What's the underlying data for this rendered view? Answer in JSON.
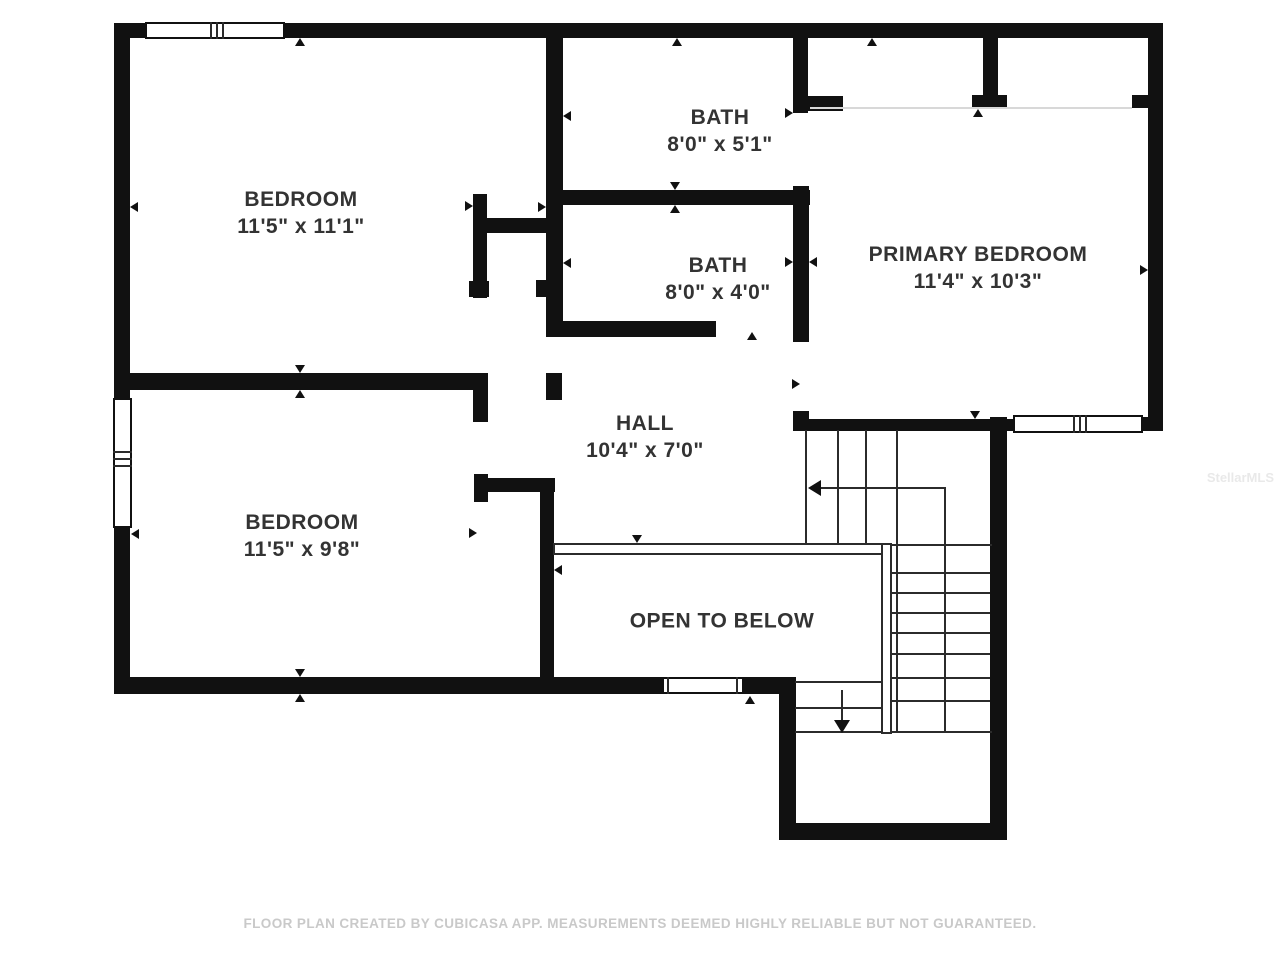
{
  "rooms": [
    {
      "id": "bedroom-top",
      "name": "BEDROOM",
      "dims": "11'5\" x 11'1\"",
      "cx": 301,
      "cy": 213
    },
    {
      "id": "bath-top",
      "name": "BATH",
      "dims": "8'0\" x 5'1\"",
      "cx": 720,
      "cy": 131
    },
    {
      "id": "bath-mid",
      "name": "BATH",
      "dims": "8'0\" x 4'0\"",
      "cx": 718,
      "cy": 279
    },
    {
      "id": "primary-bedroom",
      "name": "PRIMARY BEDROOM",
      "dims": "11'4\" x 10'3\"",
      "cx": 978,
      "cy": 268
    },
    {
      "id": "hall",
      "name": "HALL",
      "dims": "10'4\" x 7'0\"",
      "cx": 645,
      "cy": 437
    },
    {
      "id": "bedroom-bottom",
      "name": "BEDROOM",
      "dims": "11'5\" x 9'8\"",
      "cx": 302,
      "cy": 536
    },
    {
      "id": "open-to-below",
      "name": "OPEN TO BELOW",
      "dims": "",
      "cx": 722,
      "cy": 621
    }
  ],
  "caption": "FLOOR PLAN CREATED BY CUBICASA APP. MEASUREMENTS DEEMED HIGHLY RELIABLE BUT NOT GUARANTEED.",
  "watermark": "StellarMLS",
  "colors": {
    "wall": "#111111",
    "line": "#2b2b2b",
    "label": "#333333",
    "caption": "#c9c9c9",
    "watermark": "#e9e9e9",
    "background": "#ffffff"
  },
  "geometry": {
    "walls": [
      [
        114,
        23,
        1049,
        15
      ],
      [
        114,
        23,
        16,
        669
      ],
      [
        114,
        677,
        682,
        17
      ],
      [
        1148,
        23,
        15,
        408
      ],
      [
        990,
        417,
        17,
        423
      ],
      [
        779,
        677,
        17,
        163
      ],
      [
        779,
        823,
        228,
        17
      ],
      [
        114,
        373,
        374,
        17
      ],
      [
        473,
        373,
        15,
        49
      ],
      [
        546,
        23,
        17,
        314
      ],
      [
        473,
        194,
        14,
        104
      ],
      [
        483,
        218,
        67,
        15
      ],
      [
        562,
        190,
        248,
        15
      ],
      [
        546,
        321,
        170,
        16
      ],
      [
        793,
        23,
        15,
        90
      ],
      [
        793,
        96,
        50,
        15
      ],
      [
        793,
        186,
        16,
        156
      ],
      [
        793,
        411,
        16,
        20
      ],
      [
        793,
        419,
        224,
        12
      ],
      [
        1140,
        417,
        23,
        14
      ],
      [
        983,
        38,
        15,
        58
      ],
      [
        972,
        95,
        35,
        14
      ],
      [
        1132,
        95,
        20,
        13
      ],
      [
        474,
        474,
        14,
        28
      ],
      [
        475,
        478,
        80,
        14
      ],
      [
        540,
        478,
        14,
        215
      ],
      [
        546,
        373,
        16,
        27
      ],
      [
        536,
        280,
        10,
        17
      ],
      [
        469,
        281,
        20,
        16
      ]
    ],
    "windows": [
      {
        "rect": [
          145,
          22,
          140,
          17
        ],
        "mullions": [
          [
            210,
            22,
            2,
            17
          ],
          [
            216,
            22,
            2,
            17
          ],
          [
            222,
            22,
            2,
            17
          ]
        ]
      },
      {
        "rect": [
          113,
          398,
          19,
          130
        ],
        "mullions": [
          [
            113,
            451,
            19,
            2
          ],
          [
            113,
            458,
            19,
            2
          ],
          [
            113,
            465,
            19,
            2
          ]
        ]
      },
      {
        "rect": [
          662,
          677,
          82,
          17
        ],
        "mullions": [
          [
            667,
            677,
            2,
            17
          ],
          [
            736,
            677,
            2,
            17
          ]
        ]
      },
      {
        "rect": [
          1013,
          415,
          130,
          18
        ],
        "mullions": [
          [
            1073,
            415,
            2,
            18
          ],
          [
            1079,
            415,
            2,
            18
          ],
          [
            1085,
            415,
            2,
            18
          ]
        ]
      }
    ],
    "railings": [
      [
        553,
        543,
        339,
        12
      ],
      [
        881,
        543,
        11,
        191
      ]
    ],
    "faint_lines": [
      [
        810,
        107,
        322,
        2
      ]
    ],
    "lines": [
      [
        805,
        430,
        2,
        114
      ],
      [
        837,
        430,
        2,
        114
      ],
      [
        865,
        430,
        2,
        114
      ],
      [
        896,
        430,
        2,
        303
      ],
      [
        795,
        544,
        197,
        2
      ],
      [
        892,
        572,
        98,
        2
      ],
      [
        892,
        592,
        98,
        2
      ],
      [
        892,
        612,
        98,
        2
      ],
      [
        892,
        632,
        98,
        2
      ],
      [
        892,
        653,
        98,
        2
      ],
      [
        892,
        677,
        98,
        2
      ],
      [
        892,
        700,
        98,
        2
      ],
      [
        795,
        731,
        197,
        2
      ],
      [
        944,
        488,
        2,
        245
      ],
      [
        795,
        681,
        88,
        2
      ],
      [
        795,
        707,
        88,
        2
      ],
      [
        816,
        487,
        130,
        2
      ],
      [
        841,
        690,
        2,
        36
      ]
    ],
    "markers": [
      [
        300,
        38,
        "up"
      ],
      [
        677,
        38,
        "up"
      ],
      [
        872,
        38,
        "up"
      ],
      [
        130,
        207,
        "left"
      ],
      [
        546,
        207,
        "right"
      ],
      [
        563,
        116,
        "left"
      ],
      [
        473,
        206,
        "right"
      ],
      [
        563,
        263,
        "left"
      ],
      [
        793,
        262,
        "right"
      ],
      [
        809,
        262,
        "left"
      ],
      [
        793,
        113,
        "right"
      ],
      [
        675,
        190,
        "down"
      ],
      [
        675,
        205,
        "up"
      ],
      [
        752,
        332,
        "up"
      ],
      [
        300,
        373,
        "down"
      ],
      [
        300,
        390,
        "up"
      ],
      [
        800,
        384,
        "right"
      ],
      [
        975,
        419,
        "down"
      ],
      [
        978,
        109,
        "up"
      ],
      [
        1148,
        270,
        "right"
      ],
      [
        131,
        534,
        "left"
      ],
      [
        477,
        533,
        "right"
      ],
      [
        554,
        570,
        "left"
      ],
      [
        637,
        543,
        "down"
      ],
      [
        300,
        677,
        "down"
      ],
      [
        300,
        694,
        "up"
      ],
      [
        750,
        696,
        "up"
      ]
    ],
    "arrows": [
      {
        "x": 808,
        "y": 488,
        "dir": "left",
        "name": "stair-up-arrow-head"
      },
      {
        "x": 842,
        "y": 733,
        "dir": "down",
        "name": "stair-down-arrow-head"
      }
    ]
  }
}
